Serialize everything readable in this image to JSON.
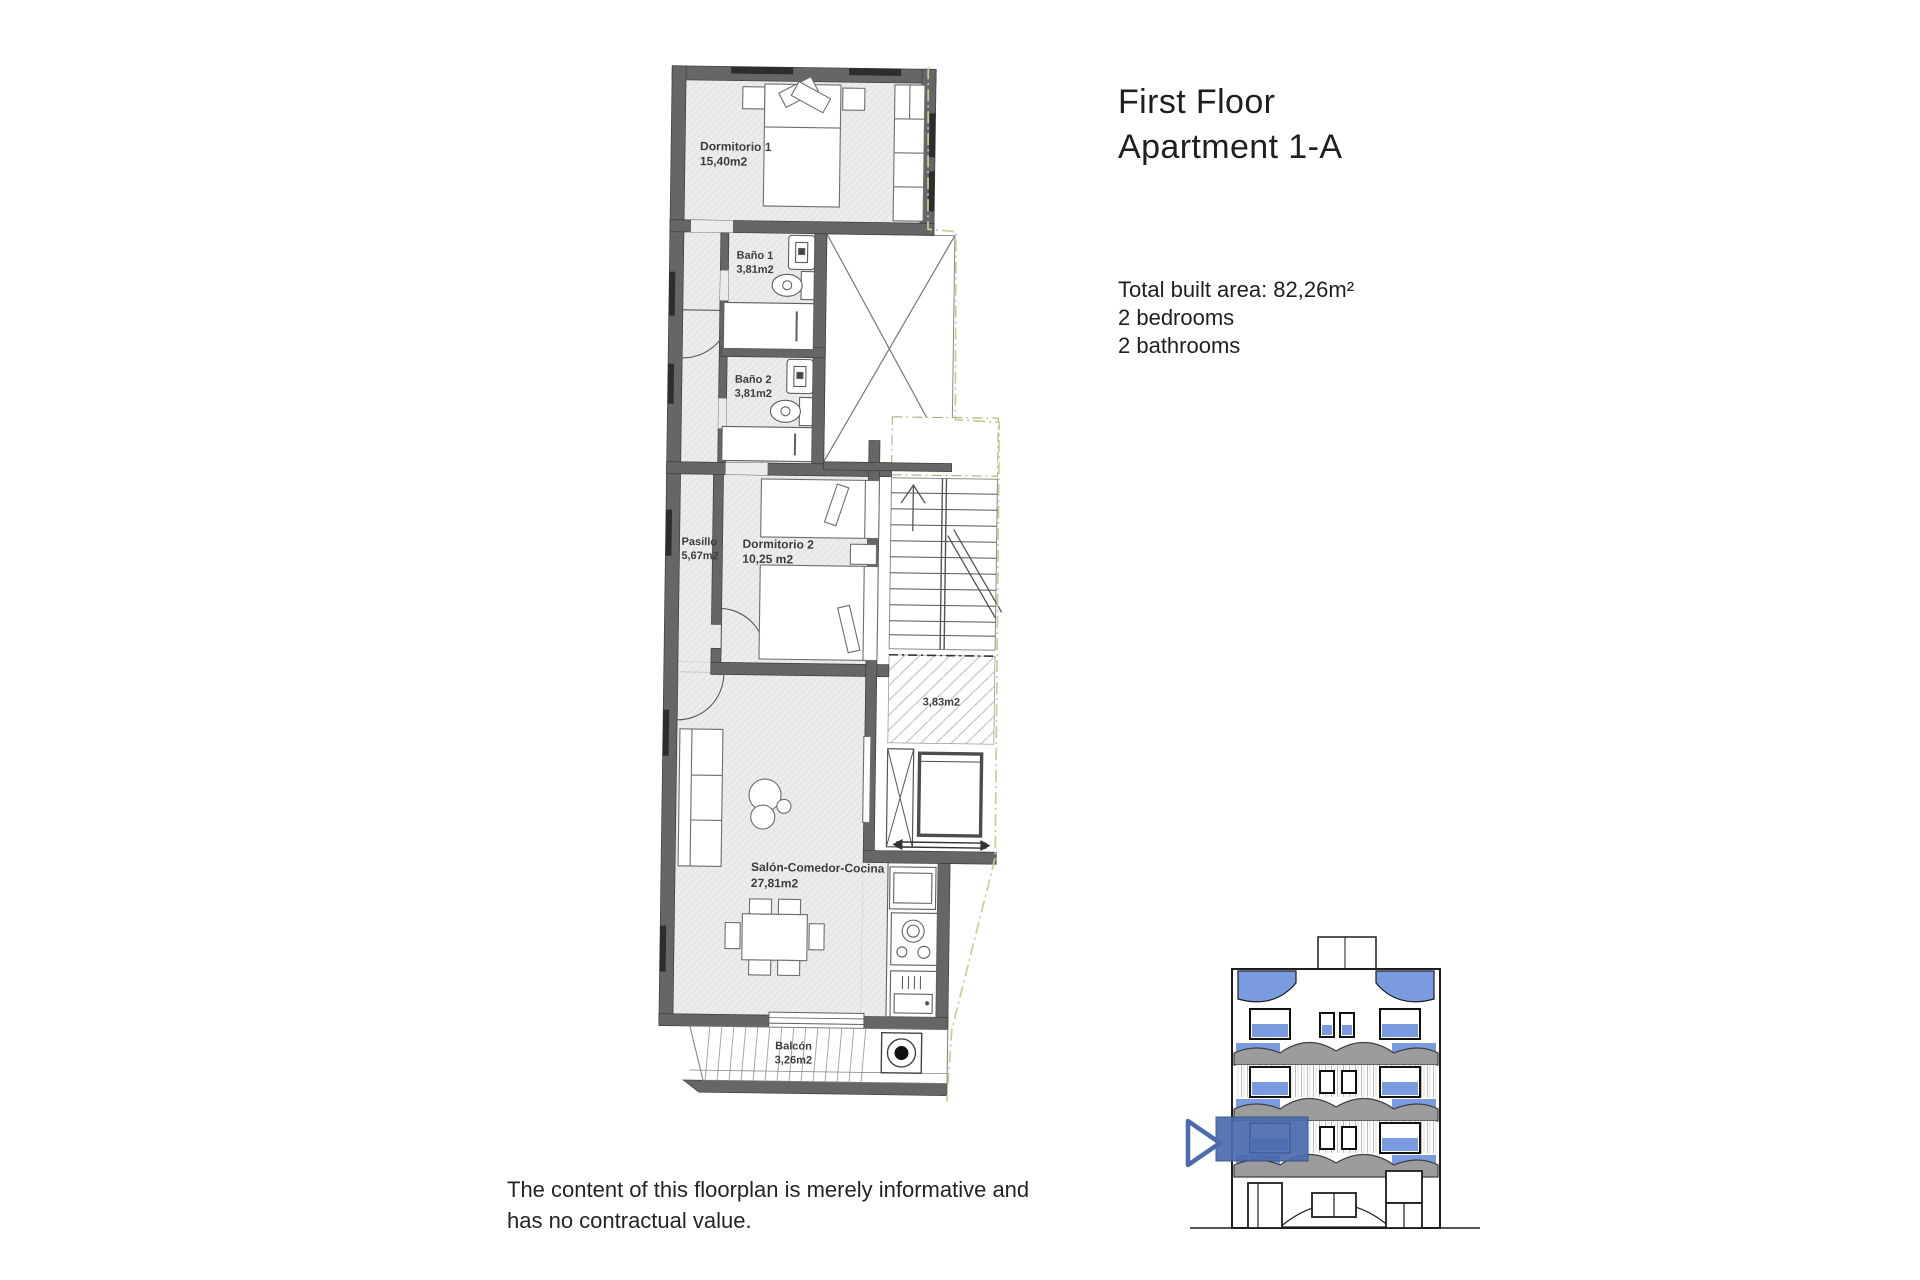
{
  "header": {
    "title_line1": "First Floor",
    "title_line2": "Apartment 1-A"
  },
  "summary": {
    "total_area": "Total built area: 82,26m²",
    "bedrooms": "2 bedrooms",
    "bathrooms": "2 bathrooms"
  },
  "disclaimer": {
    "line1": "The content of this floorplan is merely informative and",
    "line2": "has no contractual value."
  },
  "floorplan": {
    "rooms": {
      "dormitorio1": {
        "name": "Dormitorio 1",
        "area": "15,40m2"
      },
      "bano1": {
        "name": "Baño 1",
        "area": "3,81m2"
      },
      "bano2": {
        "name": "Baño 2",
        "area": "3,81m2"
      },
      "pasillo": {
        "name": "Pasillo",
        "area": "5,67m2"
      },
      "dormitorio2": {
        "name": "Dormitorio 2",
        "area": "10,25 m2"
      },
      "landing": {
        "area": "3,83m2"
      },
      "salon": {
        "name": "Salón-Comedor-Cocina",
        "area": "27,81m2"
      },
      "balcon": {
        "name": "Balcón",
        "area": "3,26m2"
      }
    }
  },
  "colors": {
    "wall": "#666666",
    "wall_dark": "#2d2d2d",
    "floor": "#edecea",
    "accent_blue": "#4a6cae",
    "glass_blue": "#7b9be0",
    "boundary_green": "#c3cf97"
  }
}
